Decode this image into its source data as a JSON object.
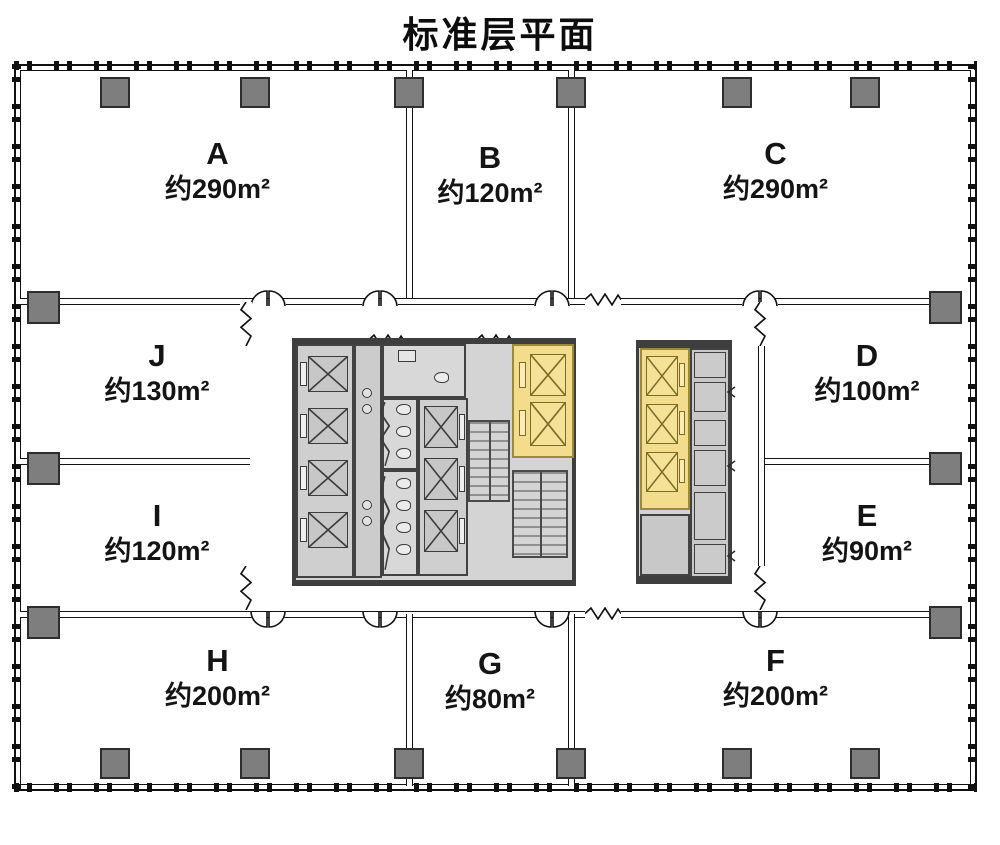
{
  "title": "标准层平面",
  "units": [
    {
      "id": "A",
      "area_label": "约290m²"
    },
    {
      "id": "B",
      "area_label": "约120m²"
    },
    {
      "id": "C",
      "area_label": "约290m²"
    },
    {
      "id": "J",
      "area_label": "约130m²"
    },
    {
      "id": "I",
      "area_label": "约120m²"
    },
    {
      "id": "D",
      "area_label": "约100m²"
    },
    {
      "id": "E",
      "area_label": "约90m²"
    },
    {
      "id": "H",
      "area_label": "约200m²"
    },
    {
      "id": "G",
      "area_label": "约80m²"
    },
    {
      "id": "F",
      "area_label": "约200m²"
    }
  ],
  "colors": {
    "wall": "#141414",
    "core_wall": "#3e3e3e",
    "core_floor": "#d4d4d4",
    "column": "#7e7e7e",
    "elevator_fill": "#c7c7c7",
    "highlight_fill": "#f3dd8d",
    "highlight_border": "#9a8a3e",
    "background": "#ffffff"
  }
}
